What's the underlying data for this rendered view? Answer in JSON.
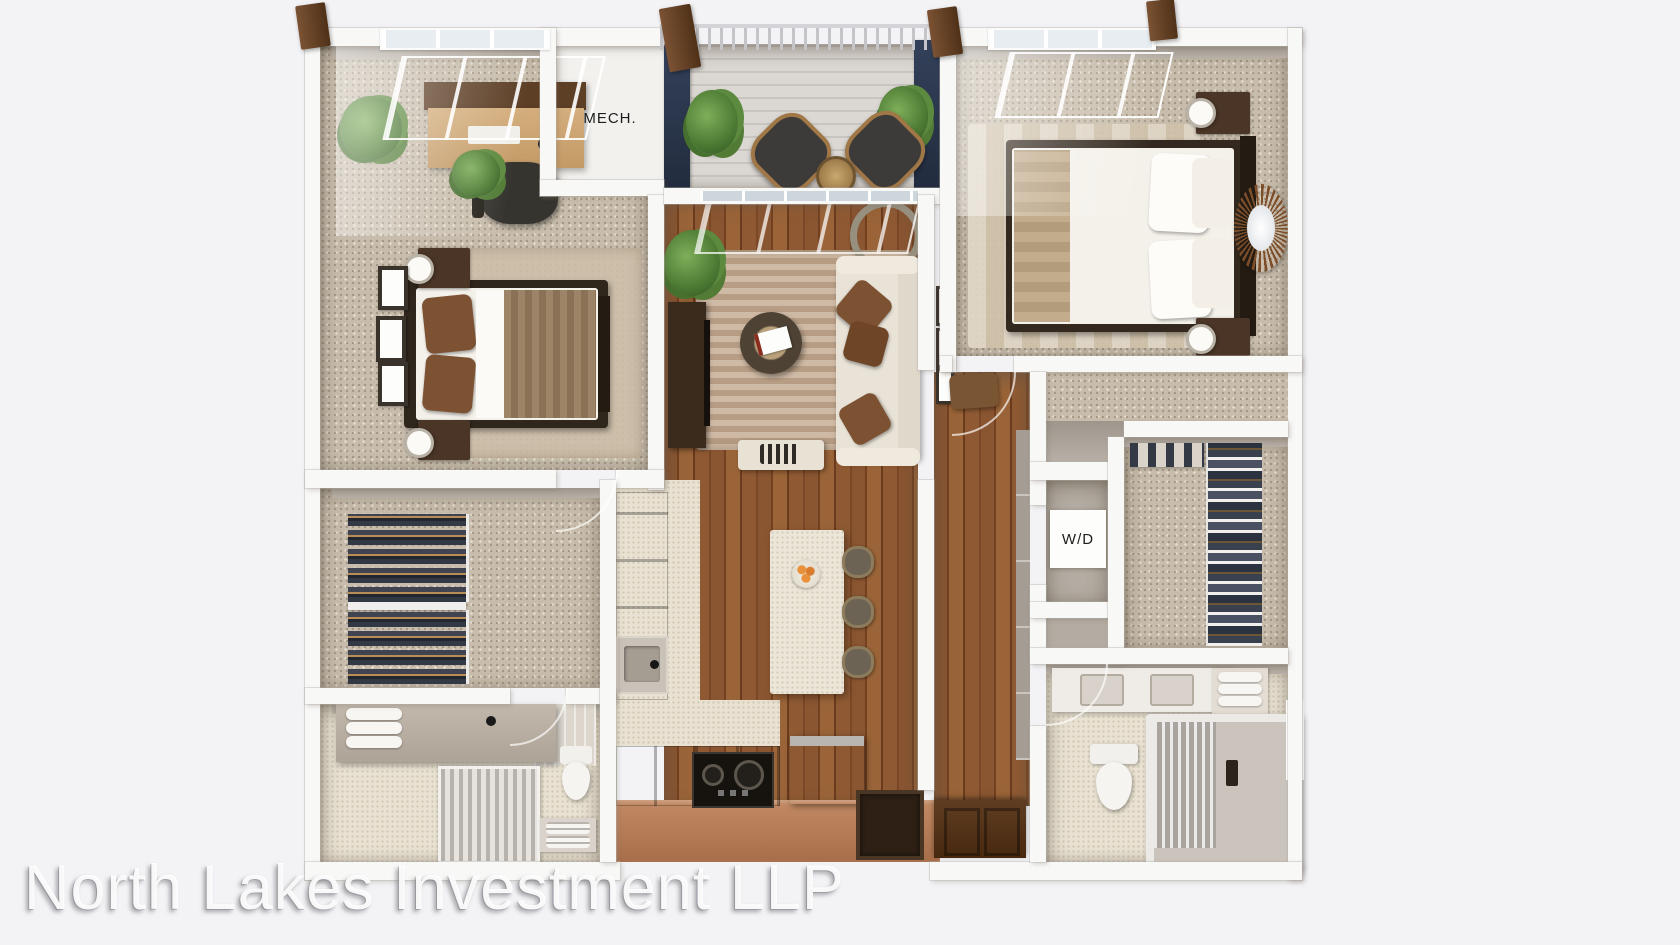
{
  "meta": {
    "description": "3D top-down rendered floor plan of a two-bedroom, two-bathroom apartment with balcony",
    "width_px": 1680,
    "height_px": 945
  },
  "watermark": {
    "text": "North Lakes Investment LLP"
  },
  "rooms": {
    "mechanical": {
      "label": "MECH."
    },
    "laundry": {
      "label": "W/D"
    }
  },
  "colors": {
    "background": "#f3f3f6",
    "wall": "#f8f8f7",
    "navy_accent": "#2e3a50",
    "wood_floor": "#8a5531",
    "carpet": "#c8bdac",
    "deck": "#d8d4d0",
    "tile": "#e9e2d2",
    "cabinet_wood": "#7d4a27",
    "terracotta_face": "#b97f5d",
    "sofa_cream": "#e9e3d7",
    "pillow_brown": "#7d5233",
    "rug_tan": "#c2a78c",
    "plant_green": "#55813a",
    "entry_door": "#53361f",
    "label_text": "#1e1e1e",
    "watermark_white": "#ffffff"
  }
}
